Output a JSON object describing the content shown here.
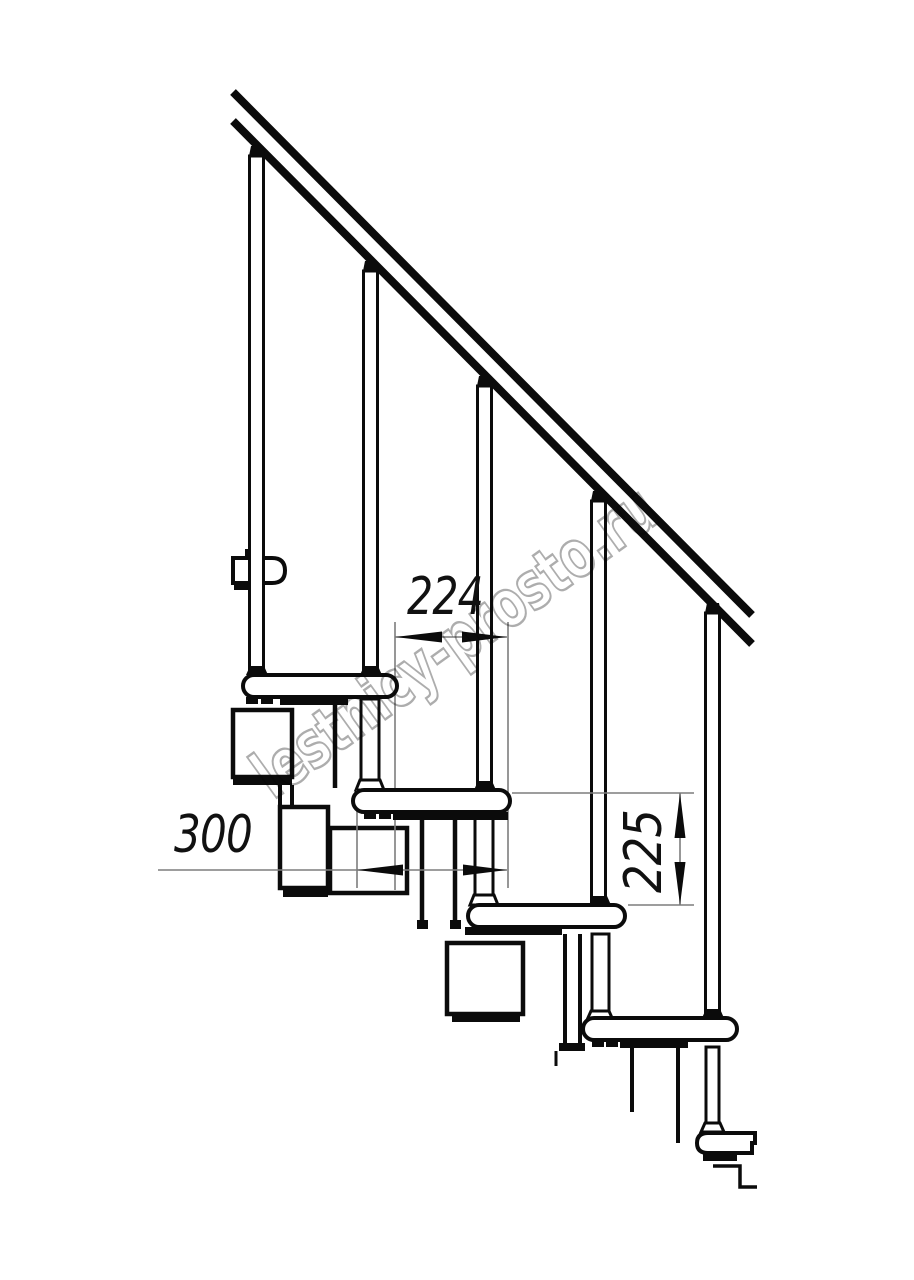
{
  "meta": {
    "background": "#ffffff",
    "line_color": "#0b0b0b",
    "dim_line_color": "#7d7d7d",
    "watermark_color": "#9f9f9f"
  },
  "watermark": {
    "text": "lestnicy-prosto.ru"
  },
  "dimensions": {
    "horizontal_offset": "224",
    "tread_depth": "300",
    "rise": "225"
  },
  "structure": {
    "visible_treads": 6,
    "balusters": 5,
    "handrail_present": true
  }
}
